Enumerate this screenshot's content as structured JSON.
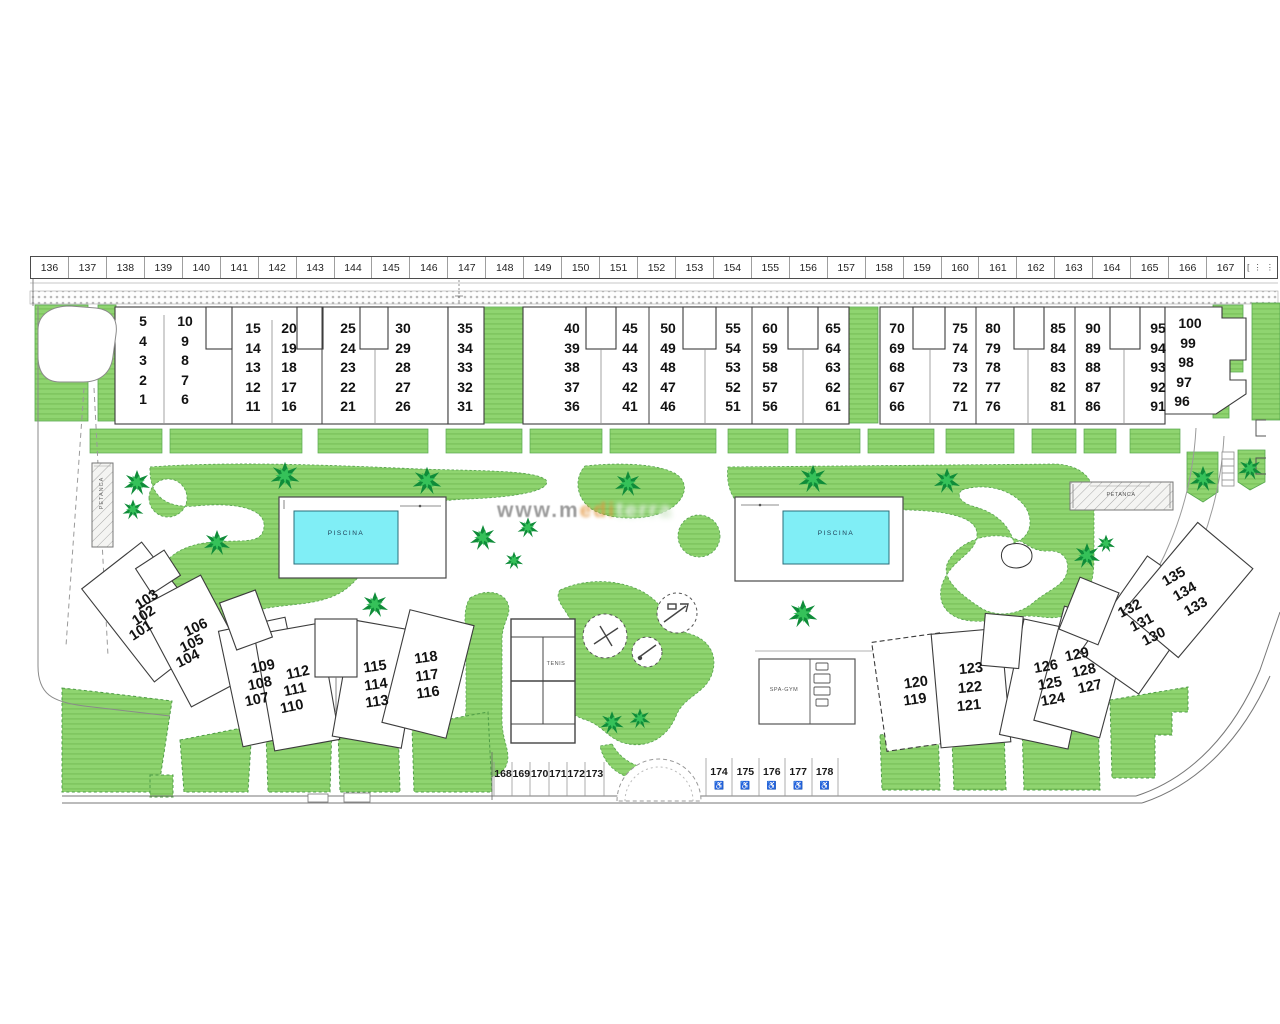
{
  "title": "residential development site plan",
  "ruler": {
    "numbers": [
      "136",
      "137",
      "138",
      "139",
      "140",
      "141",
      "142",
      "143",
      "144",
      "145",
      "146",
      "147",
      "148",
      "149",
      "150",
      "151",
      "152",
      "153",
      "154",
      "155",
      "156",
      "157",
      "158",
      "159",
      "160",
      "161",
      "162",
      "163",
      "164",
      "165",
      "166",
      "167"
    ],
    "end_marks": "[ ⋮ ⋮"
  },
  "upper_plots": {
    "columns": [
      [
        "5",
        "4",
        "3",
        "2",
        "1"
      ],
      [
        "10",
        "9",
        "8",
        "7",
        "6"
      ],
      [
        "15",
        "14",
        "13",
        "12",
        "11"
      ],
      [
        "20",
        "19",
        "18",
        "17",
        "16"
      ],
      [
        "25",
        "24",
        "23",
        "22",
        "21"
      ],
      [
        "30",
        "29",
        "28",
        "27",
        "26"
      ],
      [
        "35",
        "34",
        "33",
        "32",
        "31"
      ],
      [
        "40",
        "39",
        "38",
        "37",
        "36"
      ],
      [
        "45",
        "44",
        "43",
        "42",
        "41"
      ],
      [
        "50",
        "49",
        "48",
        "47",
        "46"
      ],
      [
        "55",
        "54",
        "53",
        "52",
        "51"
      ],
      [
        "60",
        "59",
        "58",
        "57",
        "56"
      ],
      [
        "65",
        "64",
        "63",
        "62",
        "61"
      ],
      [
        "70",
        "69",
        "68",
        "67",
        "66"
      ],
      [
        "75",
        "74",
        "73",
        "72",
        "71"
      ],
      [
        "80",
        "79",
        "78",
        "77",
        "76"
      ],
      [
        "85",
        "84",
        "83",
        "82",
        "81"
      ],
      [
        "90",
        "89",
        "88",
        "87",
        "86"
      ],
      [
        "95",
        "94",
        "93",
        "92",
        "91"
      ],
      [
        "100",
        "99",
        "98",
        "97",
        "96"
      ]
    ]
  },
  "left_fan": {
    "blocks": [
      [
        "103",
        "102",
        "101"
      ],
      [
        "106",
        "105",
        "104"
      ],
      [
        "109",
        "108",
        "107"
      ],
      [
        "112",
        "111",
        "110"
      ],
      [
        "115",
        "114",
        "113"
      ],
      [
        "118",
        "117",
        "116"
      ]
    ]
  },
  "right_fan": {
    "blocks": [
      [
        "120",
        "119"
      ],
      [
        "123",
        "122",
        "121"
      ],
      [
        "126",
        "125",
        "124"
      ],
      [
        "129",
        "128",
        "127"
      ],
      [
        "132",
        "131",
        "130"
      ],
      [
        "135",
        "134",
        "133"
      ]
    ]
  },
  "parking_left": {
    "numbers": [
      "168",
      "169",
      "170",
      "171",
      "172",
      "173"
    ]
  },
  "parking_right": {
    "numbers": [
      "174",
      "175",
      "176",
      "177",
      "178"
    ],
    "icon": "♿"
  },
  "labels": {
    "pool_left": "PISCINA",
    "pool_right": "PISCINA",
    "petanca_left": "PETANCA",
    "petanca_right": "PETANCA",
    "tennis": "TENIS",
    "spa": "SPA-GYM"
  },
  "watermark": {
    "part1": "www.m",
    "part2": "edi",
    "part3": "terra"
  },
  "colors": {
    "lawn": "#8fd470",
    "lawn_stripe": "#7cc35d",
    "pool_water": "#80eef6",
    "outline": "#3c3c3c",
    "palm_dark": "#0f8c39",
    "palm_light": "#35c159"
  }
}
